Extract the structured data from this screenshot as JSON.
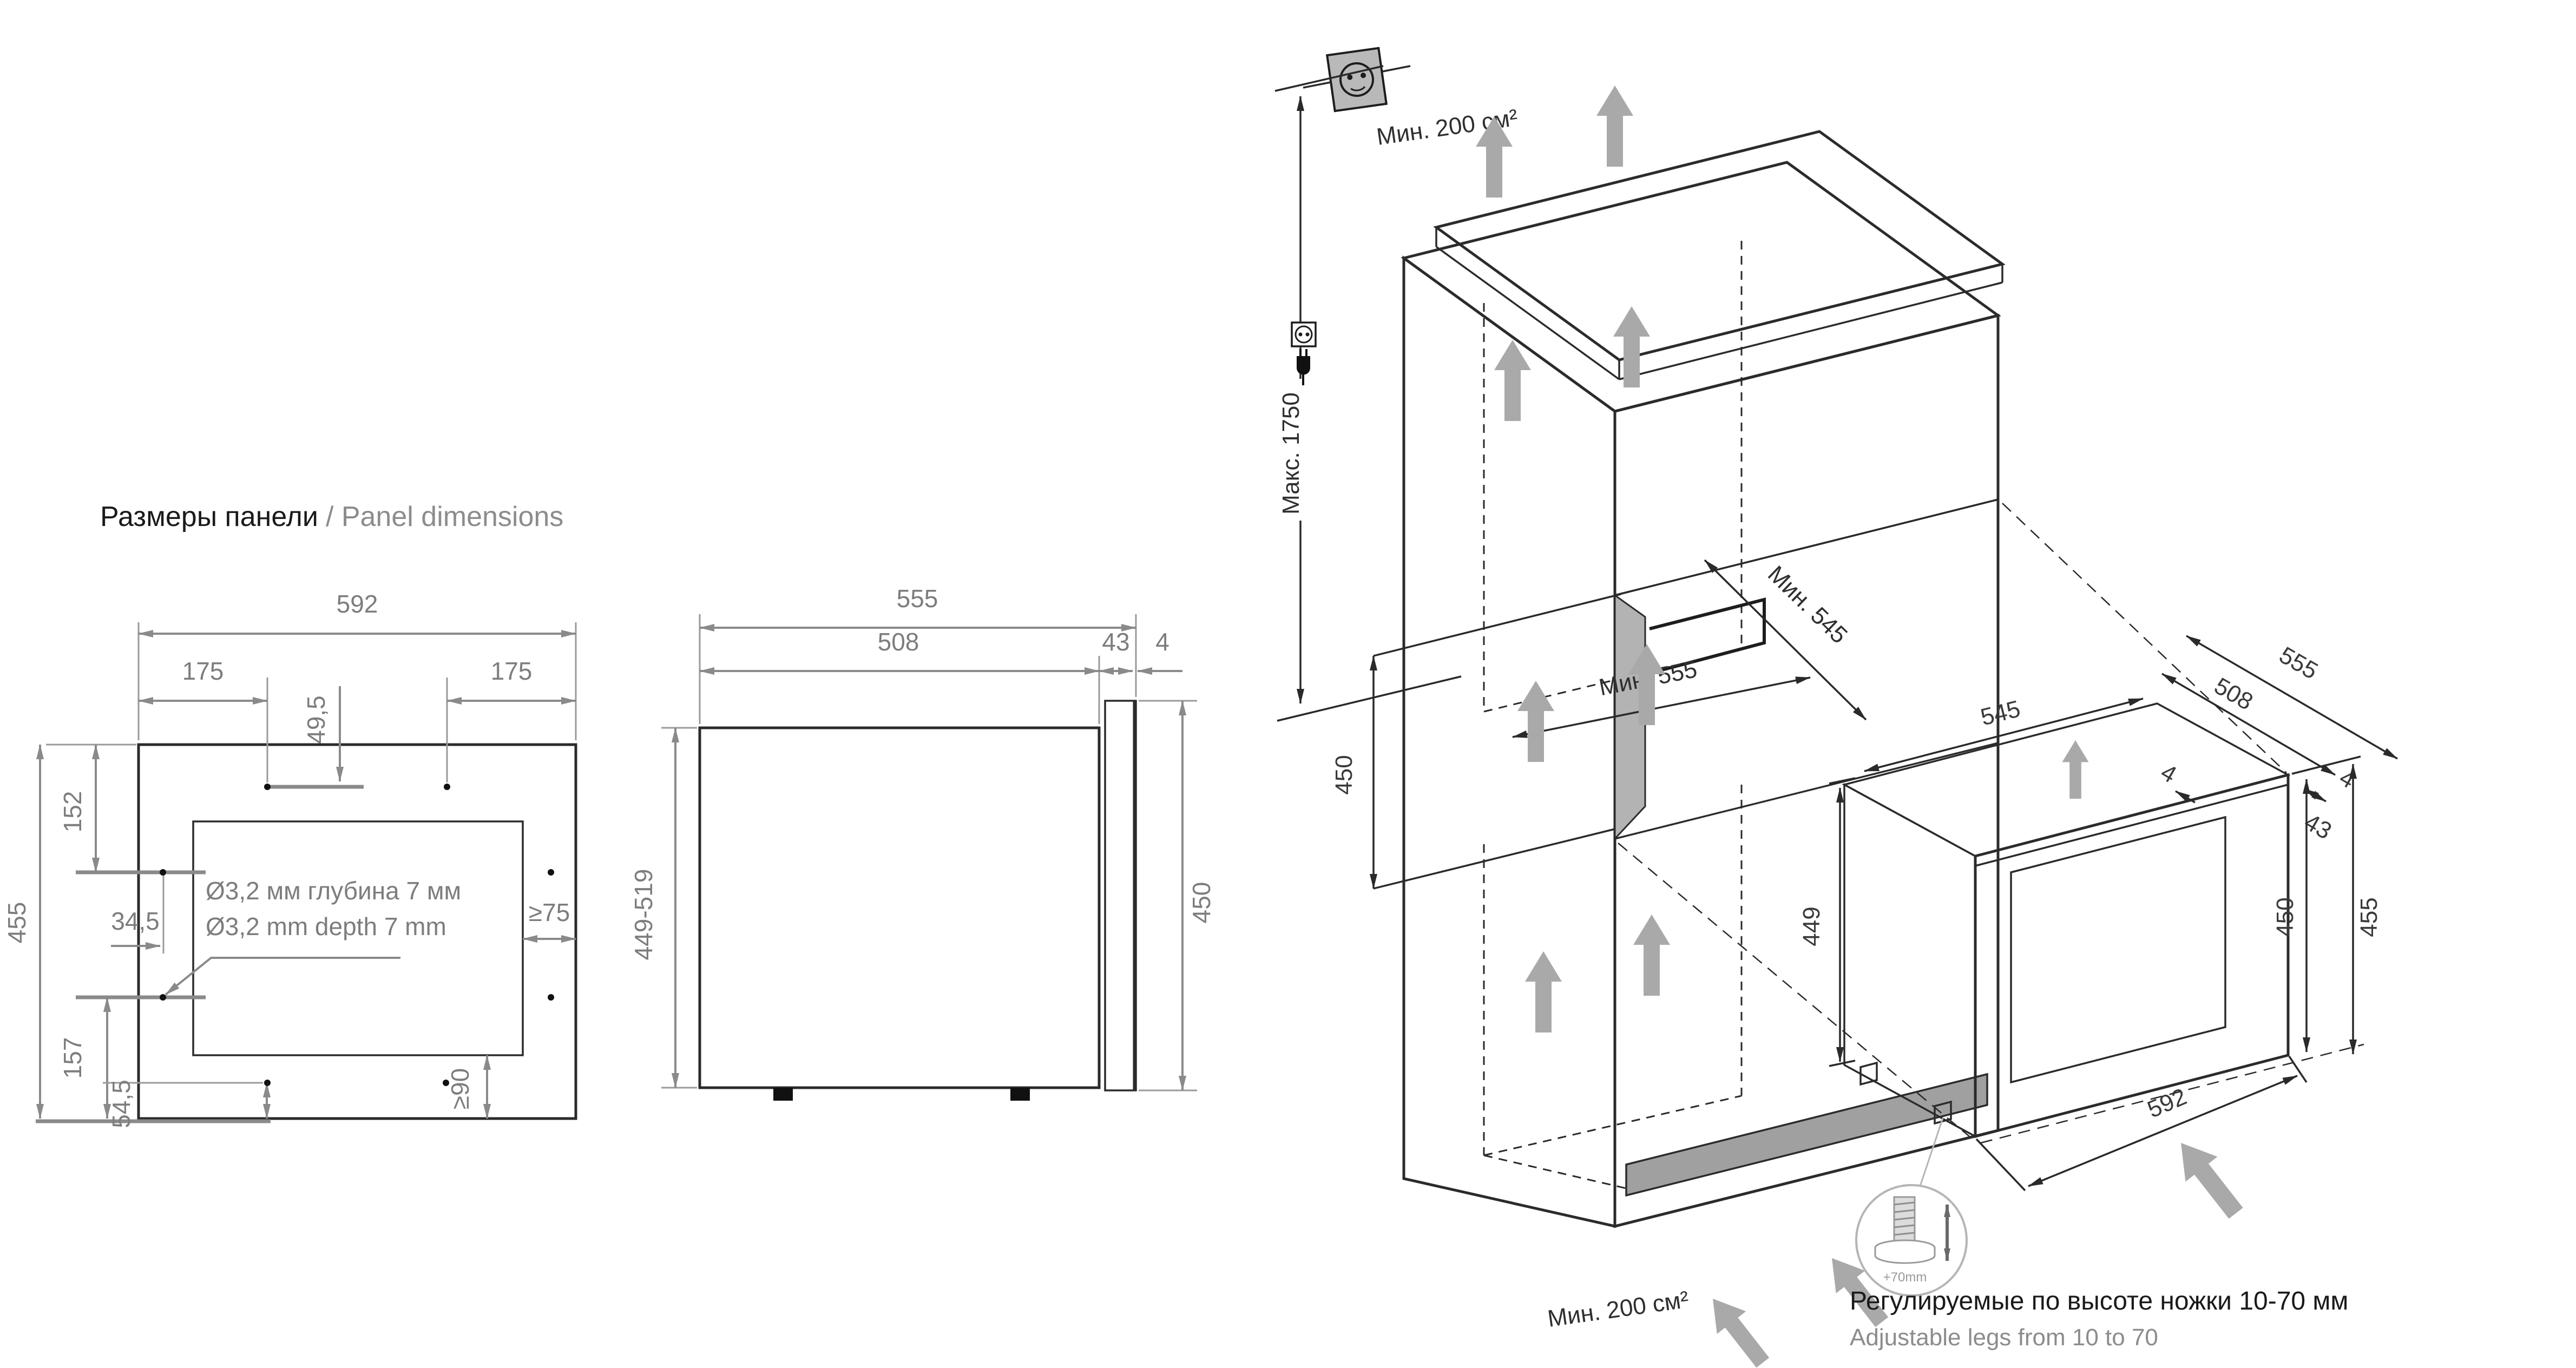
{
  "title": {
    "ru": "Размеры панели",
    "en_with_sep": "/ Panel dimensions"
  },
  "front": {
    "width": "592",
    "off_left": "175",
    "off_right": "175",
    "off_top_holes": "49,5",
    "h_152": "152",
    "h_455": "455",
    "w_345": "34,5",
    "h_157": "157",
    "h_545": "54,5",
    "ge75": "≥75",
    "ge90": "≥90",
    "note_ru": "Ø3,2 мм глубина 7 мм",
    "note_en": "Ø3,2 mm depth 7 mm"
  },
  "side": {
    "d_555": "555",
    "d_508": "508",
    "d_43": "43",
    "d_4": "4",
    "h_449_519": "449-519",
    "h_450": "450"
  },
  "install": {
    "vent_top": "Мин. 200 см²",
    "vent_bottom": "Мин. 200 см²",
    "max_height": "Макс. 1750",
    "niche_depth": "Мин. 545",
    "niche_width": "Мин. 555",
    "niche_height": "450",
    "top_545": "545",
    "depth_508": "508",
    "depth_555": "555",
    "gap_43": "43",
    "gap_4a": "4",
    "gap_4b": "4",
    "h_449": "449",
    "h_450": "450",
    "h_455": "455",
    "w_592": "592",
    "legs_range": "+70mm",
    "legs_ru": "Регулируемые по высоте ножки 10-70 мм",
    "legs_en": "Adjustable legs from 10 to 70"
  },
  "colors": {
    "line_black": "#2b2b2b",
    "dim_gray": "#8a8a8a",
    "label_gray": "#7d7d7d",
    "niche_fill": "#c9c9c9",
    "niche_side_fill": "#b3b3b3",
    "plinth_fill": "#a0a0a0",
    "airflow_arrow": "#a9a9a9",
    "socket_fill": "#b9b9b9"
  }
}
